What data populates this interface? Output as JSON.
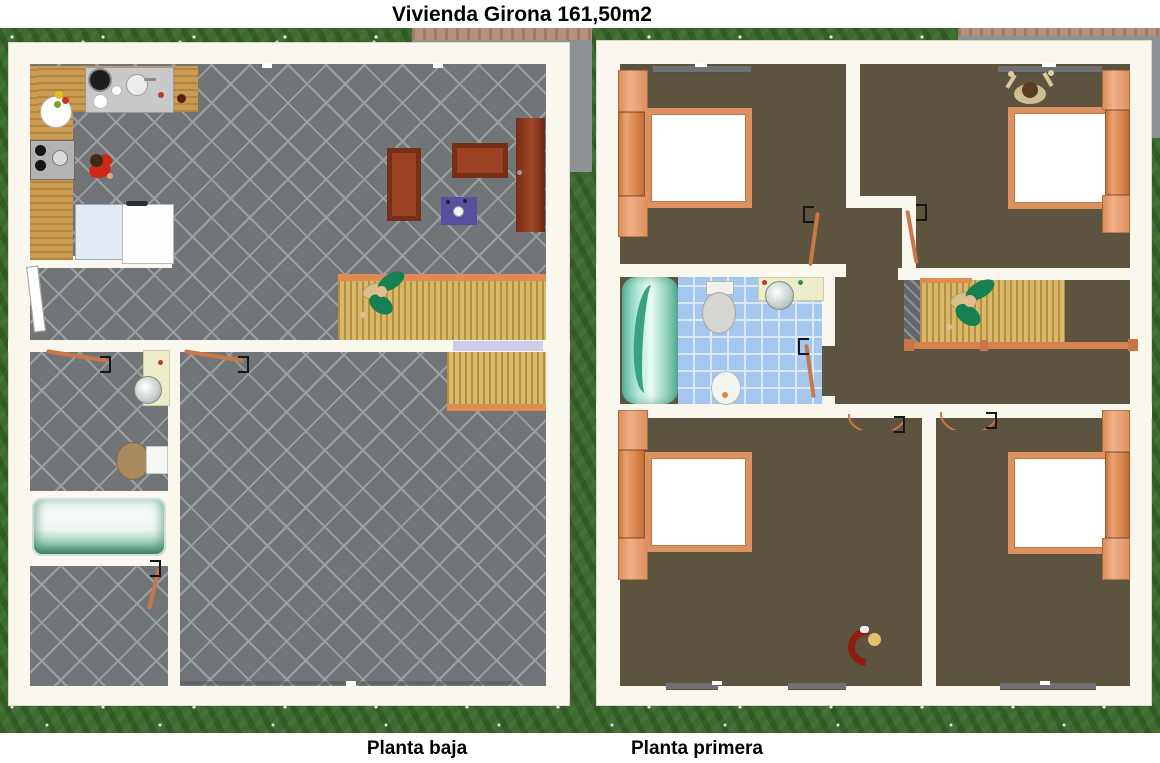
{
  "title": "Vivienda Girona 161,50m2",
  "captions": {
    "left": "Planta baja",
    "right": "Planta primera"
  },
  "colors": {
    "grass": "#3d6a30",
    "concrete": "#8f9294",
    "terrace_edge_tan": "#b5917c",
    "wall_cream": "#faf7ee",
    "tile_floor_gray": "#727578",
    "tile_line": "#9aa0a2",
    "wood_floor": "#a49b88",
    "stair_wood": "#d8b869",
    "accent_orange": "#dd8e5c",
    "door_orange": "#c97747",
    "furniture_mahogany": "#8a3721",
    "rug_purple": "#57509f",
    "bathtub_teal": "#6ab99e",
    "bathroom_tile_blue": "#a5c6ee",
    "counter_wood": "#c99c52"
  }
}
